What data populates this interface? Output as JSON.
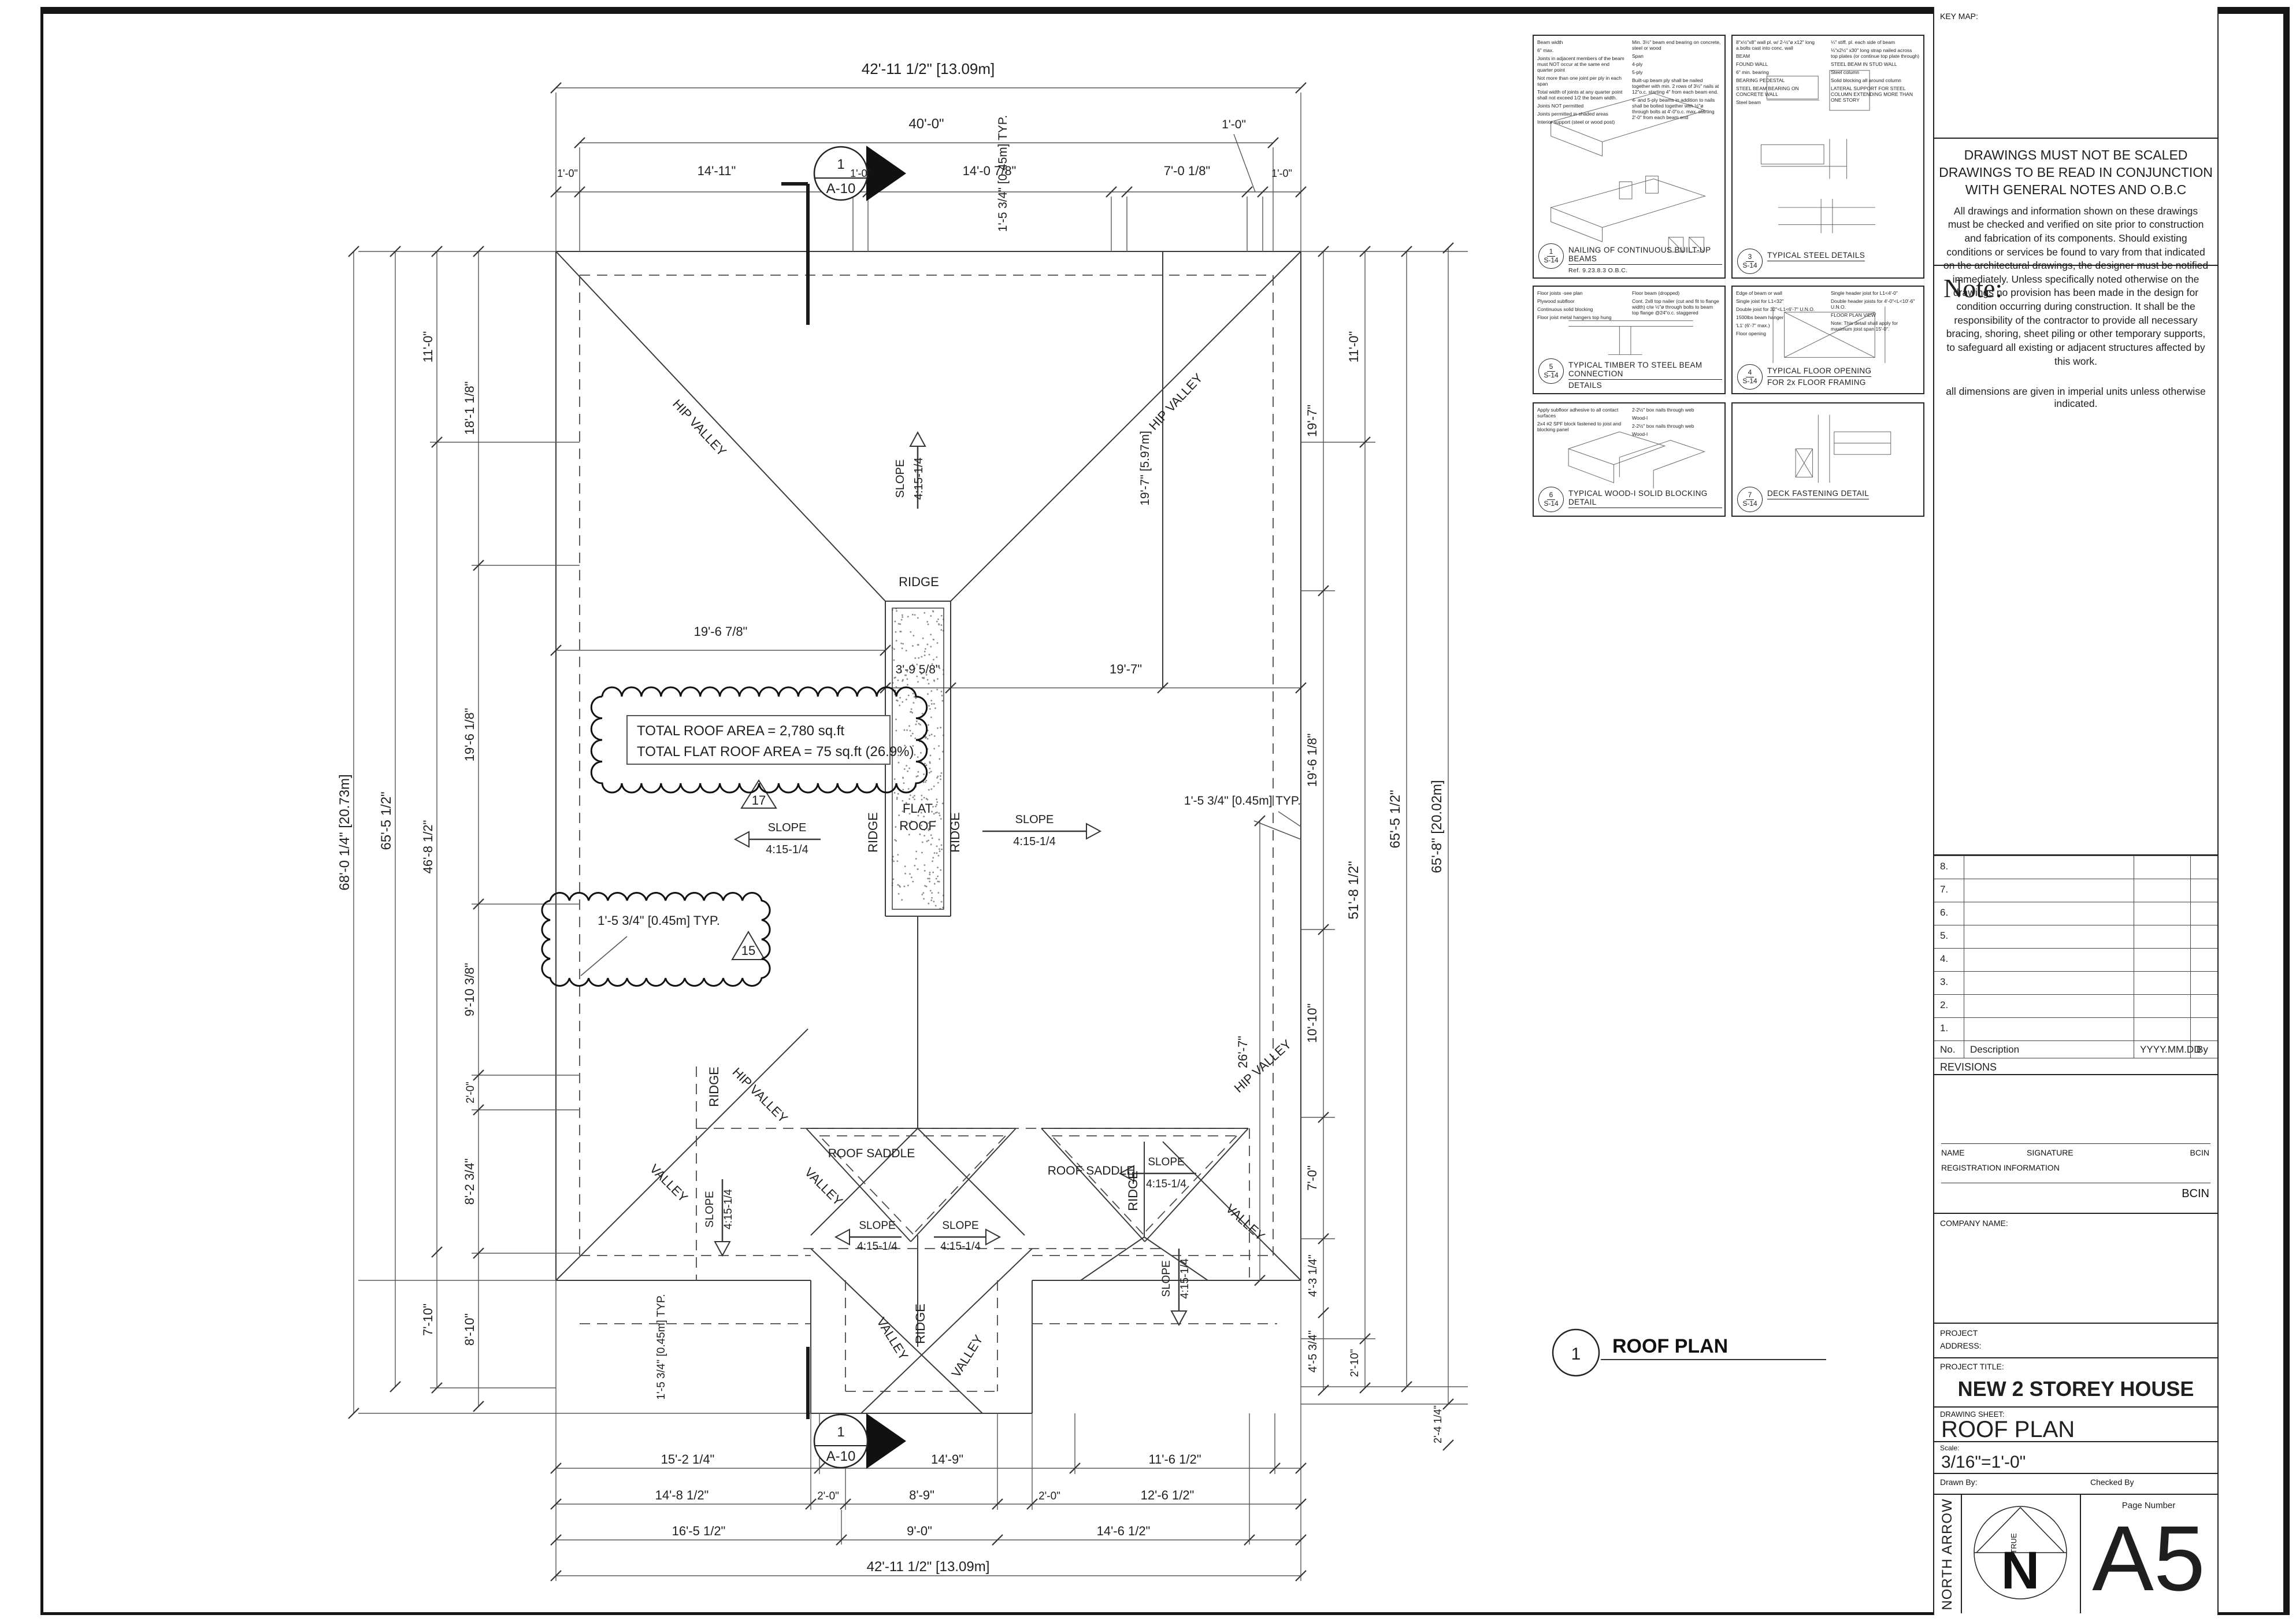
{
  "sheet": {
    "key_map_label": "KEY MAP:",
    "disclaimer": {
      "head1": "DRAWINGS MUST NOT BE SCALED",
      "head2": "DRAWINGS TO BE READ IN CONJUNCTION WITH GENERAL NOTES AND O.B.C",
      "body": "All drawings and information shown on these drawings must be checked and verified on site prior to construction and fabrication of its components. Should existing conditions or services be found to vary from that indicated on the architectural drawings, the designer must be notified immediately.  Unless specifically noted otherwise on the drawings no provision has been made in the design for condition occurring during construction.  It shall be the responsibility of the contractor to provide all necessary bracing, shoring, sheet piling or other temporary supports, to safeguard all existing or adjacent structures affected by this work.",
      "foot": "all dimensions are given in imperial units unless otherwise indicated."
    },
    "note_label": "Note:",
    "revisions": {
      "rows": [
        "8.",
        "7.",
        "6.",
        "5.",
        "4.",
        "3.",
        "2.",
        "1."
      ],
      "headers": [
        "No.",
        "Description",
        "YYYY.MM.DD",
        "By"
      ],
      "label": "REVISIONS"
    },
    "signature": {
      "name": "NAME",
      "signature": "SIGNATURE",
      "bcin": "BCIN",
      "registration": "REGISTRATION INFORMATION",
      "bcin2": "BCIN"
    },
    "company_label": "COMPANY NAME:",
    "project_label1": "PROJECT",
    "project_label2": "ADDRESS:",
    "project_title_label": "PROJECT TITLE:",
    "project_title": "NEW 2 STOREY HOUSE",
    "drawing_sheet_label": "DRAWING SHEET:",
    "drawing_sheet": "ROOF PLAN",
    "scale_label": "Scale:",
    "scale": "3/16\"=1'-0\"",
    "drawn_by_label": "Drawn By:",
    "checked_by_label": "Checked By",
    "north_arrow_label": "NORTH ARROW",
    "true_label": "TRUE",
    "north_letter": "N",
    "page_number_label": "Page Number",
    "page_number": "A5"
  },
  "details": {
    "items": [
      {
        "no": "1",
        "sheet": "S-14",
        "title": "NAILING OF CONTINUOUS BUILT-UP BEAMS",
        "title2": "",
        "ref": "Ref. 9.23.8.3 O.B.C.",
        "annotations": [
          "Beam width",
          "6\" max.",
          "Joints in adjacent members of the beam must NOT occur at the same end quarter point",
          "Not more than one joint per ply in each span",
          "Total width of joints at any quarter point shall not exceed 1/2 the beam width.",
          "Joints NOT permitted",
          "Joints permitted in shaded areas",
          "Interior support (steel or wood post)",
          "Min. 3½\" beam end bearing on concrete, steel or wood",
          "Span",
          "4-ply",
          "5-ply",
          "Built-up beam ply shall be nailed together with min. 2 rows of 3½\" nails at 12\"o.c. starting 4\" from each beam end.",
          "4- and 5-ply beams in addition to nails shall be bolted together with ½\"ø through bolts at 4'-0\"o.c. max. starting 2'-0\" from each beam end"
        ]
      },
      {
        "no": "3",
        "sheet": "S-14",
        "title": "TYPICAL STEEL DETAILS",
        "title2": "",
        "ref": "",
        "annotations": [
          "8\"x½\"x8\" wall pl. w/ 2-½\"ø x12\" long a.bolts cast into conc. wall",
          "BEAM",
          "FOUND WALL",
          "6\" min. bearing",
          "BEARING PEDESTAL",
          "STEEL BEAM BEARING ON CONCRETE WALL",
          "Steel beam",
          "¼\" stiff. pl. each side of beam",
          "⅛\"x2½\" x30\" long strap nailed across top plates (or continue top plate through)",
          "STEEL BEAM IN STUD WALL",
          "Steel column",
          "Solid blocking all around column",
          "LATERAL SUPPORT FOR STEEL COLUMN EXTENDING MORE THAN ONE STORY"
        ]
      },
      {
        "no": "5",
        "sheet": "S-14",
        "title": "TYPICAL TIMBER TO STEEL BEAM CONNECTION",
        "title2": "DETAILS",
        "ref": "",
        "annotations": [
          "Floor joists -see plan",
          "Plywood subfloor",
          "Continuous solid blocking",
          "Floor joist metal hangers top hung",
          "Floor beam (dropped)",
          "Cont. 2x8 top nailer (cut and fit to flange width) c/w ½\"ø through bolts to beam top flange @24\"o.c. staggered"
        ]
      },
      {
        "no": "4",
        "sheet": "S-14",
        "title": "TYPICAL FLOOR OPENING",
        "title2": "FOR 2x FLOOR FRAMING",
        "ref": "",
        "annotations": [
          "Edge of beam or wall",
          "Single joist for L1<32\"",
          "Double joist for 32\"<L1<6'-7\" U.N.O.",
          "1500lbs beam hanger",
          "'L1' (6'-7\" max.)",
          "Floor opening",
          "Single header joist for L1<4'-0\"",
          "Double header joists for 4'-0\"<L<10'-6\" U.N.O.",
          "FLOOR PLAN VIEW",
          "Note: This detail shall apply for maximum joist span 15'-0\"."
        ]
      },
      {
        "no": "6",
        "sheet": "S-14",
        "title": "TYPICAL WOOD-I SOLID BLOCKING DETAIL",
        "title2": "",
        "ref": "",
        "annotations": [
          "Apply subfloor adhesive to all contact surfaces",
          "2x4 #2 SPF block fastened to joist and blocking panel",
          "2-2½\" box nails through web",
          "Wood-I",
          "2-2½\" box nails through web",
          "Wood-I"
        ]
      },
      {
        "no": "7",
        "sheet": "S-14",
        "title": "DECK FASTENING DETAIL",
        "title2": "",
        "ref": "",
        "annotations": []
      }
    ]
  },
  "plan": {
    "title": {
      "no": "1",
      "label": "ROOF PLAN"
    },
    "marker": {
      "no": "1",
      "sheet": "A-10"
    },
    "labels": {
      "ridge": "RIDGE",
      "hip_valley": "HIP VALLEY",
      "valley": "VALLEY",
      "slope": "SLOPE",
      "ratio": "4:15-1/4",
      "saddle": "ROOF SADDLE",
      "flat1": "FLAT",
      "flat2": "ROOF"
    },
    "clouds": {
      "a1": "TOTAL ROOF AREA = 2,780 sq.ft",
      "a2": "TOTAL FLAT ROOF AREA = 75 sq.ft (26.9%)",
      "t17": "17",
      "typ": "1'-5 3/4\" [0.45m] TYP.",
      "t15": "15"
    },
    "dims": {
      "top": {
        "overall": "42'-11 1/2\" [13.09m]",
        "forty": "40'-0\"",
        "one_ft": "1'-0\"",
        "segs": [
          "1'-0\"",
          "14'-11\"",
          "1'-0\"",
          "14'-0 7/8\"",
          "7'-0 1/8\"",
          "1'-0\""
        ]
      },
      "bottom": {
        "r1": [
          "15'-2 1/4\"",
          "14'-9\"",
          "11'-6 1/2\""
        ],
        "r2": [
          "14'-8 1/2\"",
          "2'-0\"",
          "8'-9\"",
          "2'-0\"",
          "12'-6 1/2\""
        ],
        "r3": [
          "16'-5 1/2\"",
          "9'-0\"",
          "14'-6 1/2\""
        ],
        "overall": "42'-11 1/2\" [13.09m]"
      },
      "left": {
        "overall": "68'-0 1/4\" [20.73m]",
        "c65": "65'-5 1/2\"",
        "c11": "11'-0\"",
        "c46": "46'-8 1/2\"",
        "c710": "7'-10\"",
        "s18": "18'-1 1/8\"",
        "s19": "19'-6 1/8\"",
        "s9": "9'-10 3/8\"",
        "s2": "2'-0\"",
        "s8": "8'-2 3/4\"",
        "s810": "8'-10\""
      },
      "right": {
        "r197": "19'-7\"",
        "s196": "19'-6 1/8\"",
        "s1010": "10'-10\"",
        "s70": "7'-0\"",
        "s43": "4'-3 1/4\"",
        "s45": "4'-5 3/4\"",
        "s210": "2'-10\"",
        "s11": "11'-0\"",
        "c51": "51'-8 1/2\"",
        "c65": "65'-5 1/2\"",
        "overall": "65'-8\" [20.02m]",
        "s24": "2'-4 1/4\"",
        "typ": "1'-5 3/4\" [0.45m] TYP."
      },
      "inner": {
        "lm": "19'-6 7/8\"",
        "strip": "3'-9 5/8\"",
        "rm": "19'-7\"",
        "ur": "19'-7\" [5.97m]",
        "lr": "26'-7\"",
        "typt": "1'-5 3/4\" [0.45m] TYP.",
        "typb": "1'-5 3/4\" [0.45m] TYP."
      }
    }
  }
}
